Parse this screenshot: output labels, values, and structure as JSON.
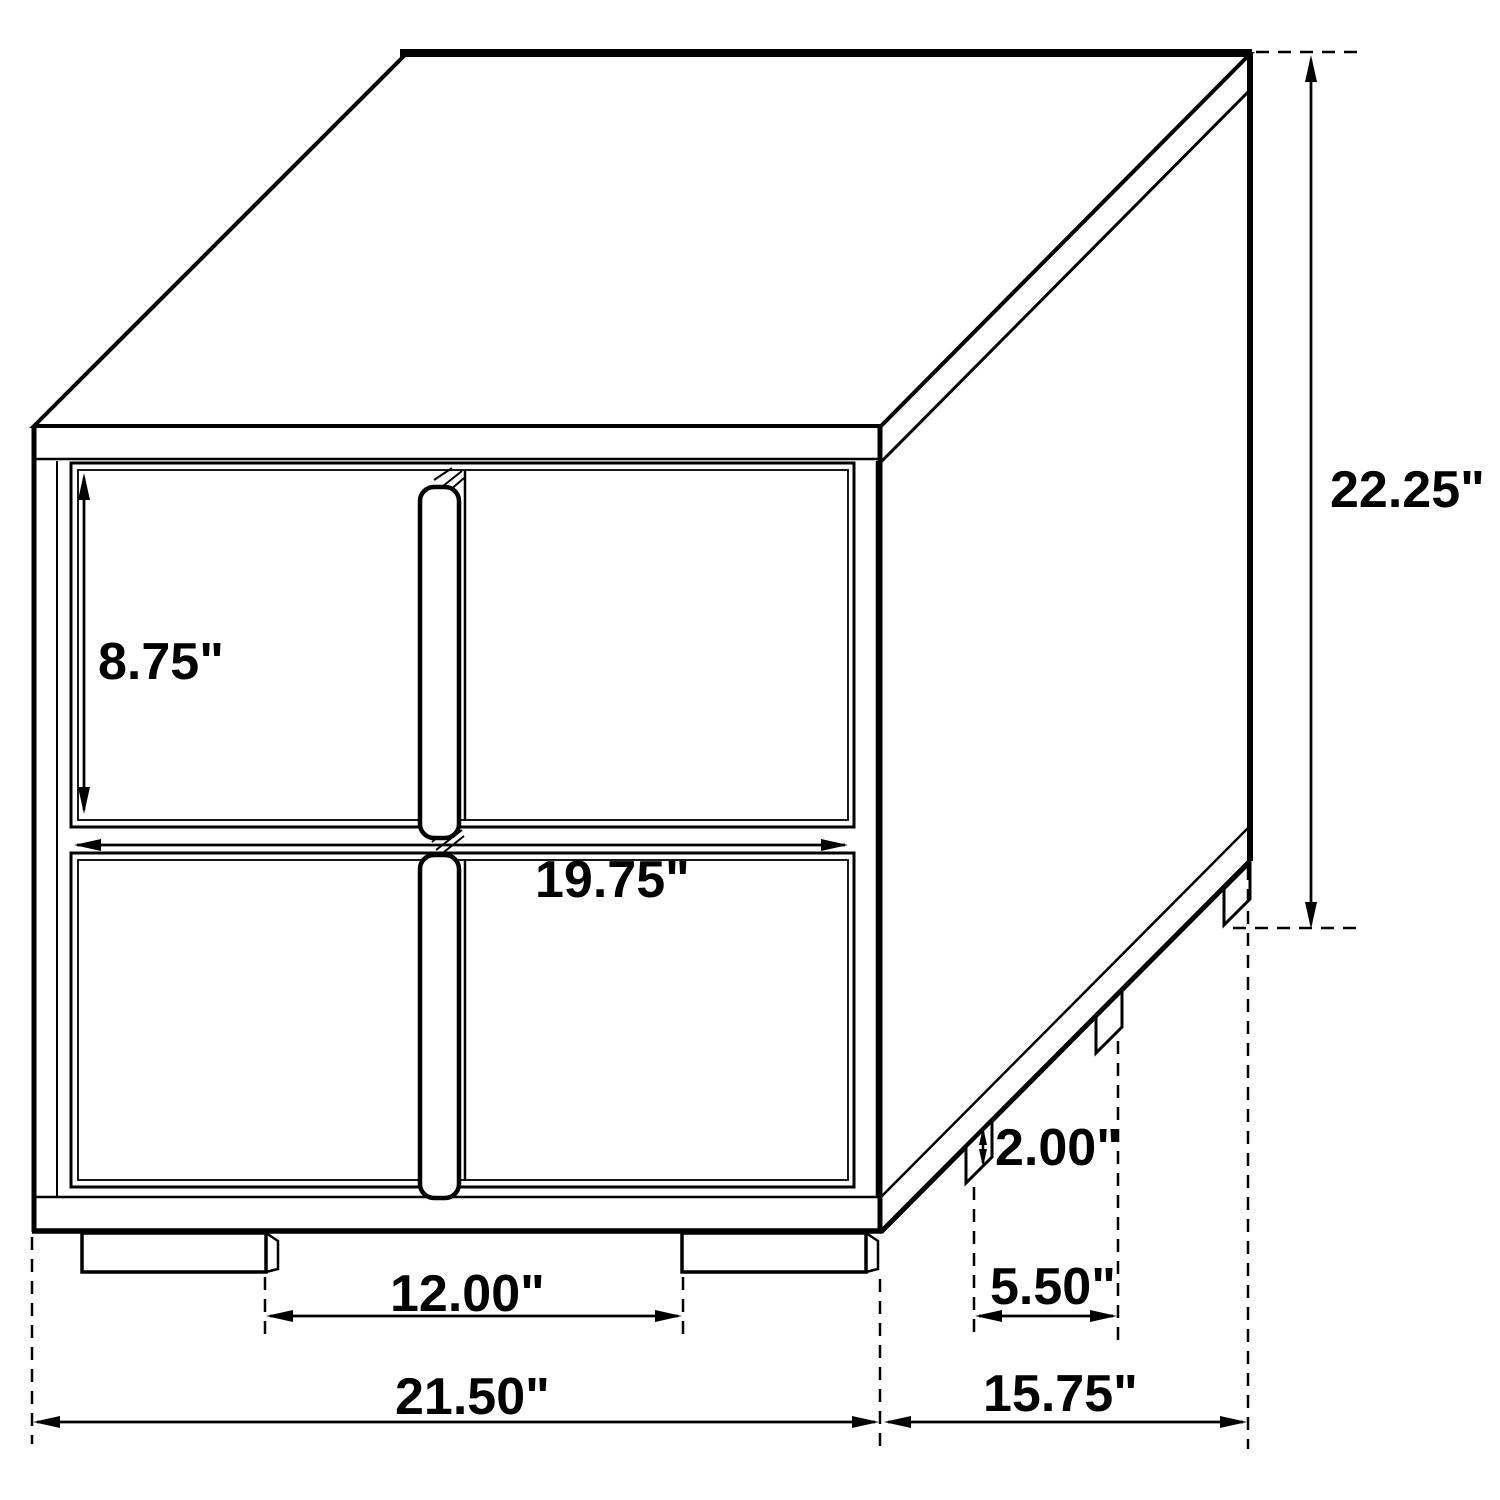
{
  "page": {
    "background_color": "#ffffff",
    "line_color": "#000000"
  },
  "diagram": {
    "type": "isometric-furniture-dimension-drawing",
    "subject": "two-drawer nightstand line drawing with dimension callouts",
    "unit": "inches",
    "dimensions": {
      "drawer_front_height": "8.75\"",
      "drawer_front_width": "19.75\"",
      "overall_height": "22.25\"",
      "foot_height": "2.00\"",
      "front_feet_gap": "12.00\"",
      "side_feet_gap": "5.50\"",
      "overall_width": "21.50\"",
      "overall_depth": "15.75\""
    }
  }
}
